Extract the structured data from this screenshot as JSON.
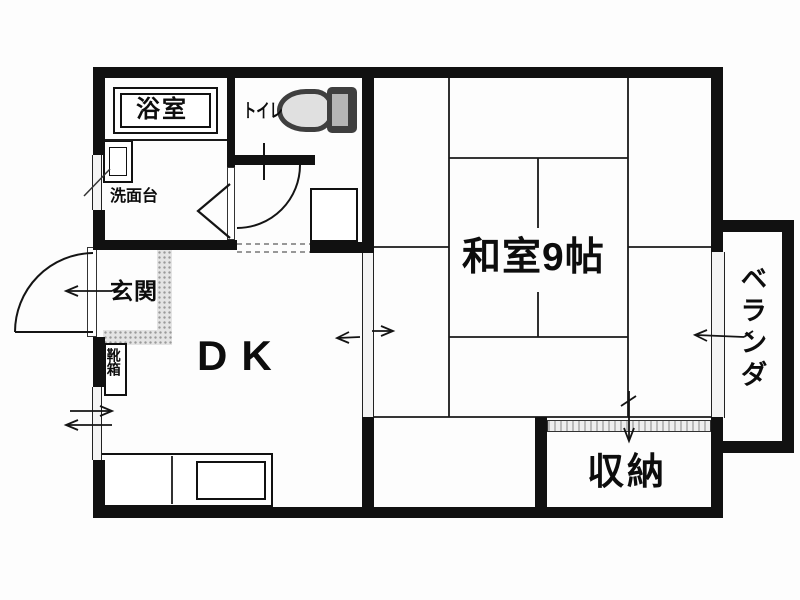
{
  "floorplan": {
    "type": "japanese-apartment-floor-plan",
    "rooms": {
      "bath": {
        "label": "浴室"
      },
      "toilet": {
        "label": "トイレ"
      },
      "washstand": {
        "label": "洗面台"
      },
      "entrance": {
        "label": "玄関"
      },
      "shoe_box": {
        "label": "靴箱"
      },
      "dining_kitchen": {
        "label": "DK"
      },
      "japanese_room": {
        "label": "和室9帖",
        "size_tatami": 9
      },
      "storage": {
        "label": "収納"
      },
      "veranda": {
        "label": "ベランダ"
      }
    },
    "colors": {
      "wall": "#111111",
      "thin_line": "#1a1a1a",
      "window_fill": "#f4f4f4",
      "sliding_hatch": "#b9b9b9",
      "step_dash": "#777777",
      "toilet_dark": "#3f3f3f",
      "genkan_bg": "#e4e4e4",
      "genkan_dot": "#9a9a9a"
    }
  }
}
